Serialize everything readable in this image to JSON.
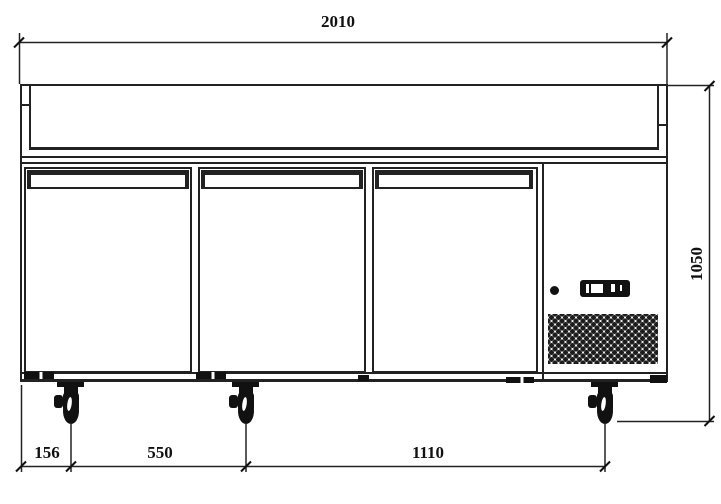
{
  "drawing": {
    "dimension_labels": {
      "overall_width": "2010",
      "overall_height": "1050",
      "caster_offset_left": "156",
      "caster_spacing_left": "550",
      "caster_spacing_right": "1110"
    },
    "colors": {
      "line": "#222222",
      "background": "#ffffff",
      "dark_fill": "#111111"
    }
  }
}
